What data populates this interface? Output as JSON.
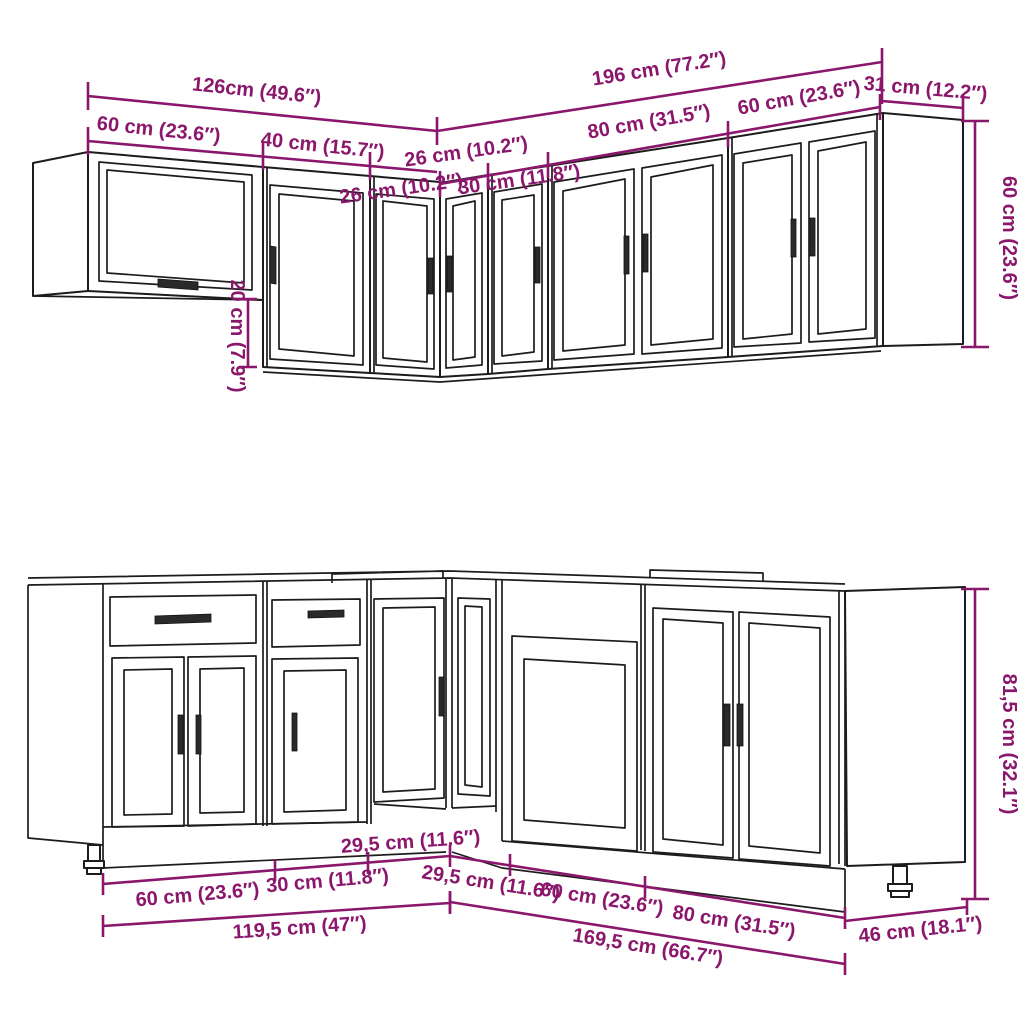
{
  "colors": {
    "dimension_accent": "#8B176C",
    "outline": "#1c1c1c",
    "background": "#ffffff"
  },
  "wall_row": {
    "total_left": "126cm (49.6″)",
    "seg_60_left": "60 cm (23.6″)",
    "seg_40": "40 cm (15.7″)",
    "seg_26_left": "26 cm (10.2″)",
    "total_right": "196 cm (77.2″)",
    "seg_26_right": "26 cm (10.2″)",
    "seg_30": "30 cm (11.8″)",
    "seg_80": "80 cm (31.5″)",
    "seg_60_right": "60 cm (23.6″)",
    "depth": "31 cm (12.2″)",
    "height": "60 cm (23.6″)",
    "underhang": "20 cm (7.9″)"
  },
  "base_row": {
    "seg_60_left": "60 cm (23.6″)",
    "seg_30": "30 cm (11.8″)",
    "seg_295_left": "29,5 cm (11.6″)",
    "total_left": "119,5 cm (47″)",
    "seg_295_right": "29,5 cm (11.6″)",
    "seg_60_right": "60 cm (23.6″)",
    "seg_80": "80 cm (31.5″)",
    "total_right": "169,5 cm (66.7″)",
    "depth": "46 cm (18.1″)",
    "height": "81,5 cm (32.1″)"
  }
}
